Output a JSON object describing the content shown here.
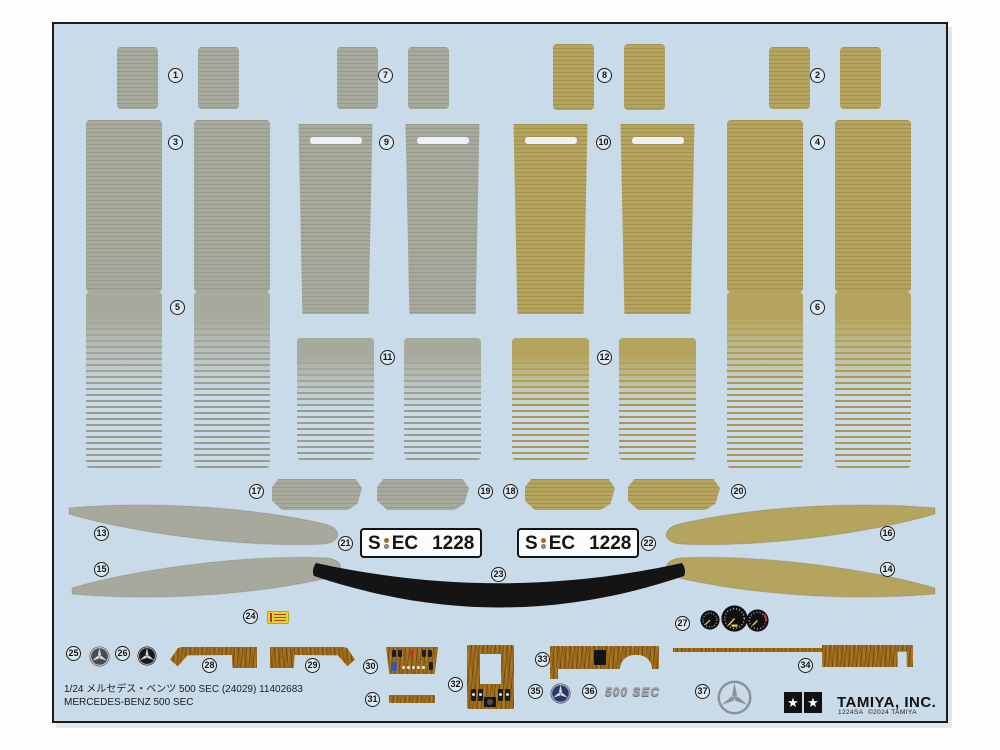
{
  "nums": {
    "n1": "1",
    "n2": "2",
    "n3": "3",
    "n4": "4",
    "n5": "5",
    "n6": "6",
    "n7": "7",
    "n8": "8",
    "n9": "9",
    "n10": "10",
    "n11": "11",
    "n12": "12",
    "n13": "13",
    "n14": "14",
    "n15": "15",
    "n16": "16",
    "n17": "17",
    "n18": "18",
    "n19": "19",
    "n20": "20",
    "n21": "21",
    "n22": "22",
    "n23": "23",
    "n24": "24",
    "n25": "25",
    "n26": "26",
    "n27": "27",
    "n28": "28",
    "n29": "29",
    "n30": "30",
    "n31": "31",
    "n32": "32",
    "n33": "33",
    "n34": "34",
    "n35": "35",
    "n36": "36",
    "n37": "37"
  },
  "plate": {
    "prefix": "S",
    "letters": "EC",
    "digits": "1228"
  },
  "emblem": {
    "text": "500 SEC"
  },
  "footer": {
    "line1": "1/24 メルセデス・ベンツ 500 SEC (24029) 11402683",
    "line2": "MERCEDES-BENZ 500 SEC"
  },
  "brand": {
    "name": "TAMIYA, INC.",
    "code": "1224SA",
    "copyright": "©2024 TAMIYA",
    "star": "★"
  },
  "colors": {
    "sheet_blue": "#c9dbe8",
    "decal_gray": "#a7a99c",
    "decal_tan": "#b4a45e",
    "wood_brown": "#9a6a1c",
    "trim_black": "#141414",
    "plate_white": "#fbfdfc",
    "badge_yellow": "#dcd92a",
    "chrome_silver": "#9aa0a6"
  }
}
